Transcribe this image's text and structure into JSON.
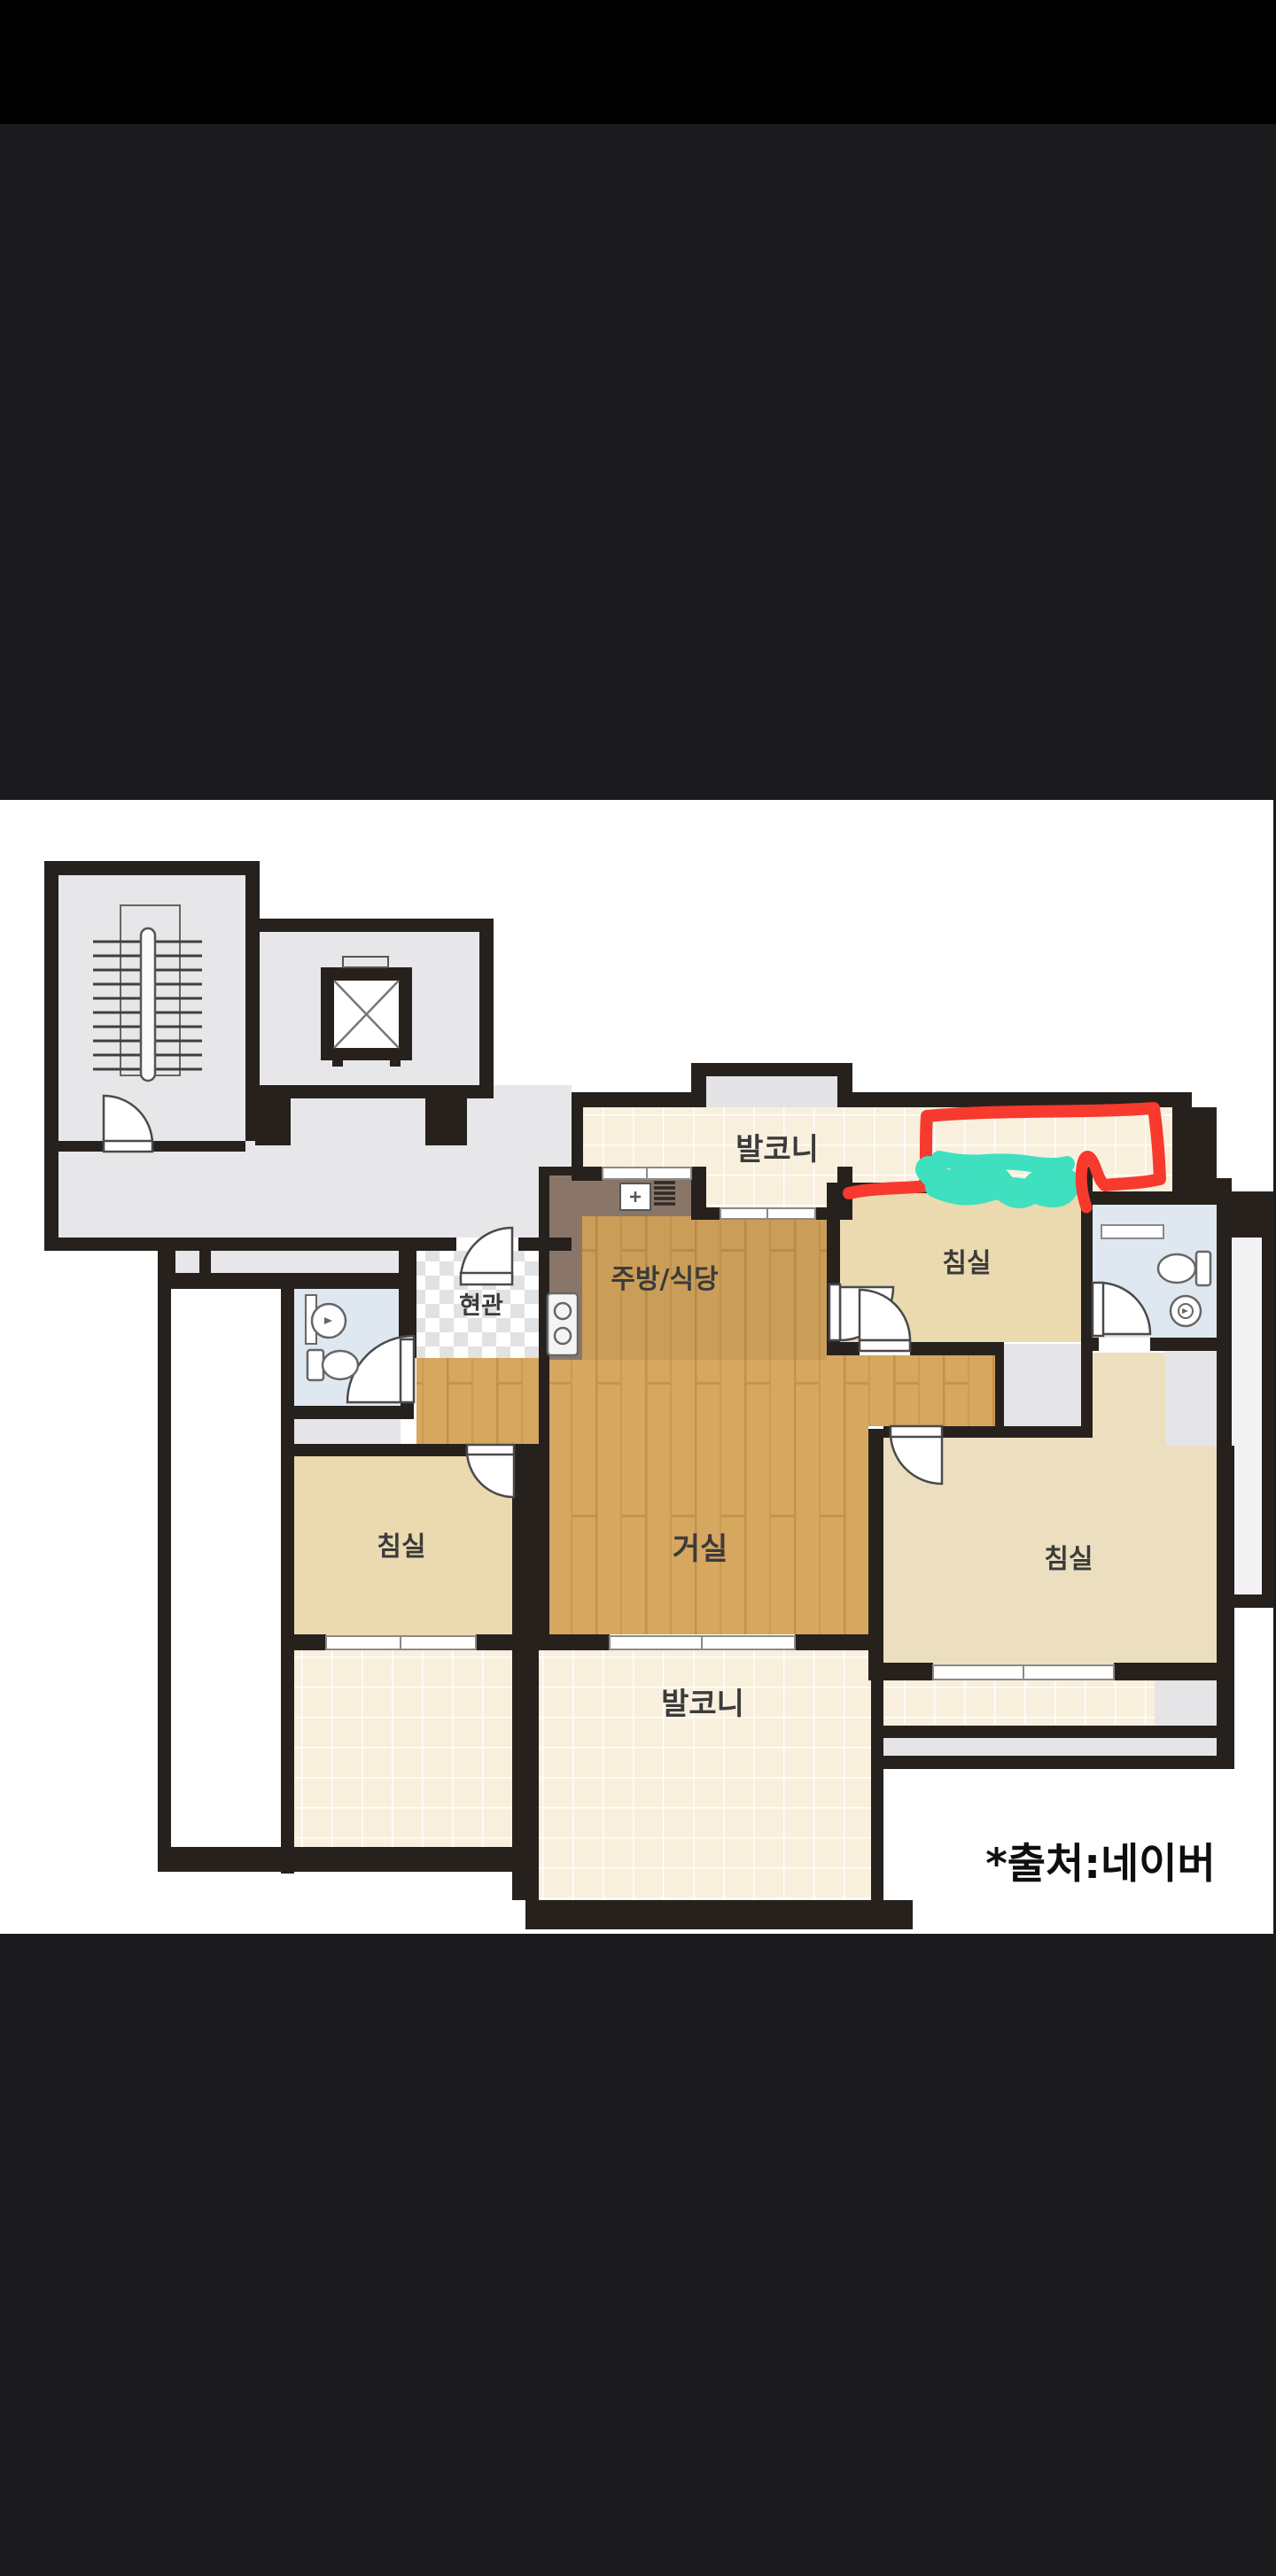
{
  "screen": {
    "type": "mobile image viewer showing an apartment floor plan",
    "background_top_color": "#000000",
    "background_color": "#1b1b1d",
    "canvas_color": "#ffffff"
  },
  "floorplan": {
    "source_caption": "*출처:네이버",
    "rooms": [
      {
        "name": "balcony-top",
        "label": "발코니"
      },
      {
        "name": "bedroom-top-right",
        "label": "침실"
      },
      {
        "name": "kitchen-dining",
        "label": "주방/식당"
      },
      {
        "name": "entrance",
        "label": "현관"
      },
      {
        "name": "bedroom-left",
        "label": "침실"
      },
      {
        "name": "living-room",
        "label": "거실"
      },
      {
        "name": "bedroom-bottom-right",
        "label": "침실"
      },
      {
        "name": "balcony-bottom",
        "label": "발코니"
      }
    ],
    "fixtures": [
      "staircase",
      "elevator",
      "toilet",
      "sink",
      "washer",
      "gas-stove",
      "range-hood",
      "vent-grille"
    ],
    "annotation": {
      "shape": "hand-drawn rectangle over right section of top balcony",
      "highlight_color": "#f8392e",
      "scribble_color": "#3ee0bf"
    },
    "colors": {
      "wall": "#26211d",
      "common_area": "#e7e7e9",
      "bedroom_floor": "#ebd9b0",
      "balcony_tile": "#f8efdd",
      "wood_floor": "#d5a75f",
      "bathroom_floor": "#dfe8f0"
    }
  }
}
